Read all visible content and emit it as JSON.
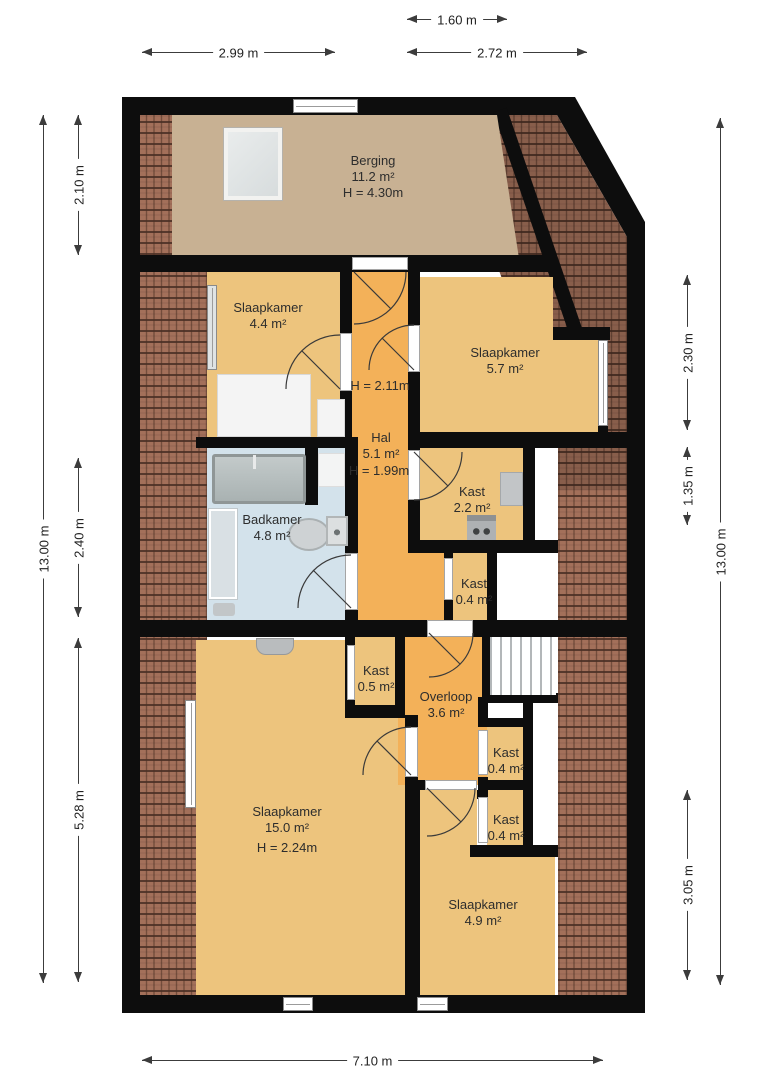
{
  "plan": {
    "rooms": {
      "berging": {
        "name": "Berging",
        "area": "11.2 m²",
        "height": "H = 4.30m"
      },
      "slaapkamer1": {
        "name": "Slaapkamer",
        "area": "4.4 m²"
      },
      "slaapkamer2": {
        "name": "Slaapkamer",
        "area": "5.7 m²"
      },
      "hal": {
        "name": "Hal",
        "area": "5.1 m²",
        "height_upper": "H = 2.11m",
        "height_lower": "H = 1.99m"
      },
      "kast_groot": {
        "name": "Kast",
        "area": "2.2 m²"
      },
      "badkamer": {
        "name": "Badkamer",
        "area": "4.8 m²"
      },
      "kast_hal": {
        "name": "Kast",
        "area": "0.4 m²"
      },
      "kast_half": {
        "name": "Kast",
        "area": "0.5 m²"
      },
      "overloop": {
        "name": "Overloop",
        "area": "3.6 m²"
      },
      "kast_a": {
        "name": "Kast",
        "area": "0.4 m²"
      },
      "kast_b": {
        "name": "Kast",
        "area": "0.4 m²"
      },
      "slaapkamer3": {
        "name": "Slaapkamer",
        "area": "15.0 m²",
        "height": "H = 2.24m"
      },
      "slaapkamer4": {
        "name": "Slaapkamer",
        "area": "4.9 m²"
      }
    },
    "dimensions": {
      "top_small": "1.60 m",
      "top_left": "2.99 m",
      "top_right": "2.72 m",
      "bottom": "7.10 m",
      "left_outer": "13.00 m",
      "left_top": "2.10 m",
      "left_mid": "2.40 m",
      "left_bottom": "5.28 m",
      "right_outer": "13.00 m",
      "right_top": "2.30 m",
      "right_mid": "1.35 m",
      "right_bottom": "3.05 m"
    },
    "colors": {
      "wall": "#0d0d0d",
      "room_tan": "#edc47d",
      "room_orange": "#f3b159",
      "berging_floor": "#c8b193",
      "bathroom_floor": "#d3e2eb",
      "roof_tile": "#a3705a"
    }
  }
}
